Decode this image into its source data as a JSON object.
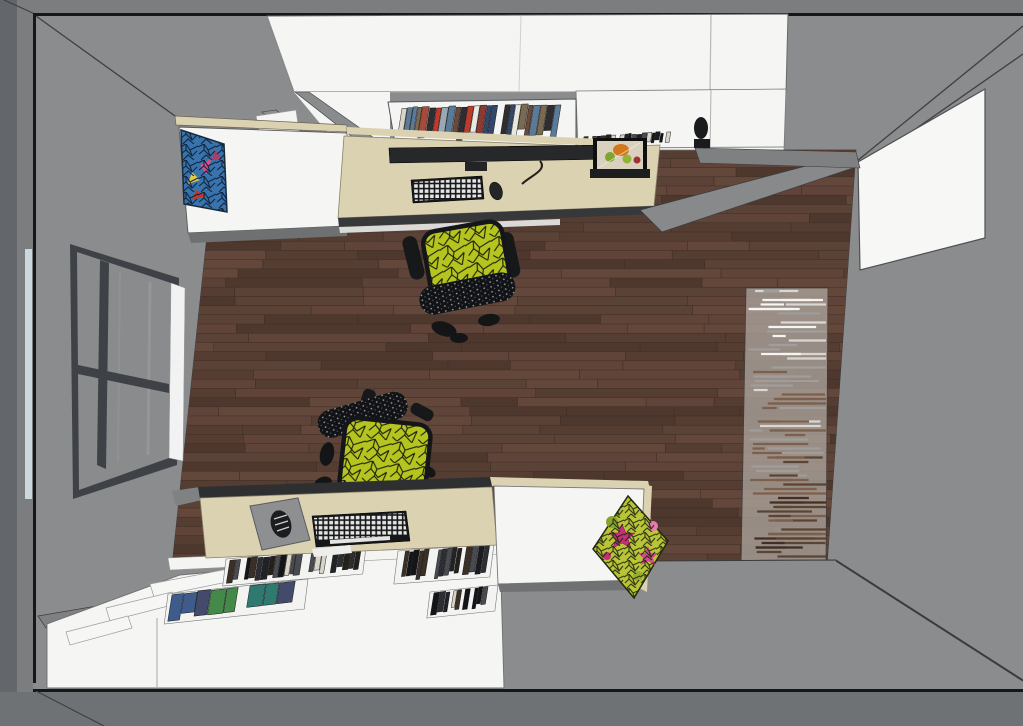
{
  "scene": {
    "type": "3d-interior-render-top-down-view",
    "room": "home office / study with wraparound white cabinetry",
    "camera": "overhead plan view with slight perspective, gray walls visible around dark wood floor",
    "objects": [
      "left-wall-window",
      "right-wall-door",
      "upper-wall-cabinets",
      "upper-bookshelf",
      "upper-desk",
      "monitor",
      "upper-keyboard",
      "upper-mouse",
      "fruit-still-life-art",
      "upper-daybed",
      "blue-patterned-pillow",
      "office-chair-1",
      "office-chair-2",
      "area-rug",
      "lower-desk",
      "mousepad",
      "lower-mouse",
      "lower-keyboard",
      "lower-bookcase",
      "lower-daybed",
      "pink-green-pillow",
      "waste-bin",
      "wood-plank-floor"
    ]
  },
  "colors": {
    "outside": "#7b7d7e",
    "outside_bottom": "#6f7274",
    "left_strip": "#63676b",
    "wall": "#8a8c8d",
    "floor": "#5b4237",
    "rug_base": "#a9a19a",
    "desk_wood": "#dbd2b2",
    "cabinet_white": "#f5f5f4",
    "door_white": "#f7f7f6",
    "chair_mesh": "#b5c41f",
    "chair_frame": "#141517",
    "window_frame": "#3e4246",
    "glass": "#898b8c",
    "sill": "#f1f2f1",
    "window_reflection": "#ccd7dd",
    "monitor": "#26282a",
    "keyboard": "#16171a",
    "keys": "#e6e6e4",
    "pad": "#8d8f91",
    "pillow_blue": "#3873ad",
    "pillow2_base": "#b9c437",
    "accent_magenta": "#c42f78",
    "art_orange": "#d2771c"
  },
  "palettes": {
    "floor_planks": [
      "#5b4237",
      "#63473a",
      "#553d32",
      "#4e382e",
      "#604439"
    ],
    "rug_stripes": [
      "#f4f4f2",
      "#d9d7d3",
      "#a09d9a",
      "#7c5f4c",
      "#5a4433",
      "#412f24"
    ],
    "books_top": [
      "#5a7a96",
      "#8a3a32",
      "#c9b893",
      "#e9e7e1",
      "#32486a",
      "#7a6a52",
      "#a84a3a",
      "#2e2e30",
      "#9aa8b4",
      "#6a4a3a",
      "#c0392b",
      "#d8d4c8"
    ],
    "books_dark": [
      "#141518",
      "#202226",
      "#2c2e33",
      "#3a3026",
      "#1a1c20",
      "#494b50",
      "#26201a",
      "#d8d4c8"
    ],
    "books_color": [
      "#3d5c8c",
      "#5c4a8c",
      "#2f7a70",
      "#44884a",
      "#8c2e3c",
      "#722430",
      "#444a6a",
      "#2a3a5a",
      "#4f7a43"
    ]
  }
}
